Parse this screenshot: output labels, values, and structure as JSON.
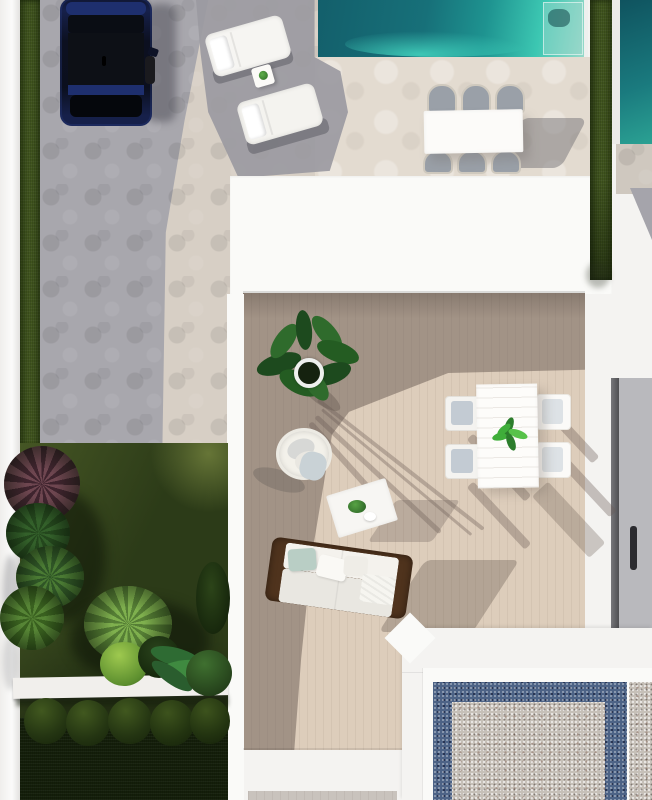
{
  "scene": {
    "type": "aerial-architectural-render",
    "description": "Top-down 3D render of a modern villa plot: carport with dark blue SUV on hexagonal grey paving, turquoise pool with two sun loungers and a six-chair dining set, lower roof terrace with wood deck, hanging chair, sofa, coffee table and four-chair dining set, side garden with palms, burgundy cordyline, ball hedges and white bench, and a neighbouring patio of blue-bordered pebble gravel.",
    "objects": [
      {
        "name": "car",
        "description": "dark blue SUV parked top-left on grey hexagonal paving"
      },
      {
        "name": "sun-loungers",
        "description": "two white sun loungers with a small side table and plant"
      },
      {
        "name": "main-pool",
        "description": "turquoise swimming pool with corner step panel"
      },
      {
        "name": "pool-dining-set",
        "description": "white rectangular table with six grey chairs beside the pool"
      },
      {
        "name": "left-hedge",
        "description": "narrow green hedge strip along the left boundary wall"
      },
      {
        "name": "right-hedge",
        "description": "green hedge strip along the right boundary"
      },
      {
        "name": "terrace-deck",
        "description": "beige wood-plank roof terrace, partly in shadow"
      },
      {
        "name": "potted-plant",
        "description": "leafy green plant in a round white pot casting long shadows"
      },
      {
        "name": "hanging-chair",
        "description": "white wicker hanging egg chair with grey cushions"
      },
      {
        "name": "coffee-table",
        "description": "small white coffee table with greenery and a dish"
      },
      {
        "name": "outdoor-sofa",
        "description": "wood-framed sofa with white cushions and a mint pillow"
      },
      {
        "name": "terrace-dining-set",
        "description": "white table with plant centerpiece and four chairs"
      },
      {
        "name": "garden",
        "description": "dark lawn with palms, burgundy cordyline, white ledge and five ball hedges"
      },
      {
        "name": "gravel-patio",
        "description": "neighbouring patio of light pebbles framed by a blue pebble border"
      },
      {
        "name": "neighbour-pool",
        "description": "corner of a second teal pool at the top-right"
      },
      {
        "name": "neighbour-wall",
        "description": "grey wall with a dark handle slot on the right edge"
      }
    ],
    "counts": {
      "sun_loungers": 2,
      "pool_dining_chairs": 6,
      "terrace_dining_chairs": 4,
      "hedge_balls": 5,
      "cars": 1
    }
  },
  "palette": {
    "wall": "#f4f3f1",
    "wall_bright": "#fafaf8",
    "pave_grey": "#a8a7ad",
    "pave_grey_dark": "#9b9aa1",
    "pave_beige": "#d7cfc5",
    "pave_beige_light": "#e3dbd0",
    "pool_deep": "#135f6b",
    "pool_mid": "#1e9390",
    "pool_bright": "#3cc7b2",
    "pool_pale": "#99d9c9",
    "hedge": "#41551f",
    "hedge_dark": "#25330e",
    "lawn": "#2c3b18",
    "lawn_dark": "#141f0a",
    "lawn_light": "#5a6c2e",
    "deck": "#ddcdbb",
    "wood": "#4f331d",
    "mint": "#b9cec5",
    "car_navy": "#16204a",
    "car_black": "#0b0e14",
    "car_blue": "#1e2f6e",
    "chair_steel": "#9aa0a8",
    "chair_pale": "#c3cbd3",
    "pebble_blue": "#4d6386",
    "pebble_light": "#c6c0b8",
    "leaf_dark": "#1d4a1e",
    "leaf_mid": "#2f6b2c",
    "leaf_bright": "#3fae3a",
    "palm_light": "#7fb04e",
    "burgundy": "#6e4650",
    "shadow": "rgba(104,90,82,0.35)"
  }
}
